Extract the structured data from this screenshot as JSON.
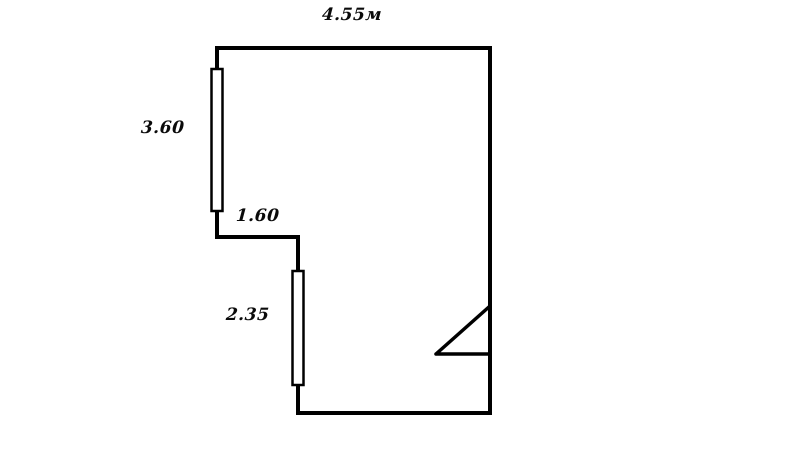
{
  "diagram": {
    "kind": "floor-plan",
    "background_color": "#ffffff",
    "line_color": "#000000",
    "dimension_labels": {
      "top_width": "4.55м",
      "left_height": "3.60",
      "step_width": "1.60",
      "lower_left_height": "2.35"
    },
    "symbols": {
      "left_window": "window",
      "lower_window": "window",
      "right_door": "door-swing"
    }
  }
}
